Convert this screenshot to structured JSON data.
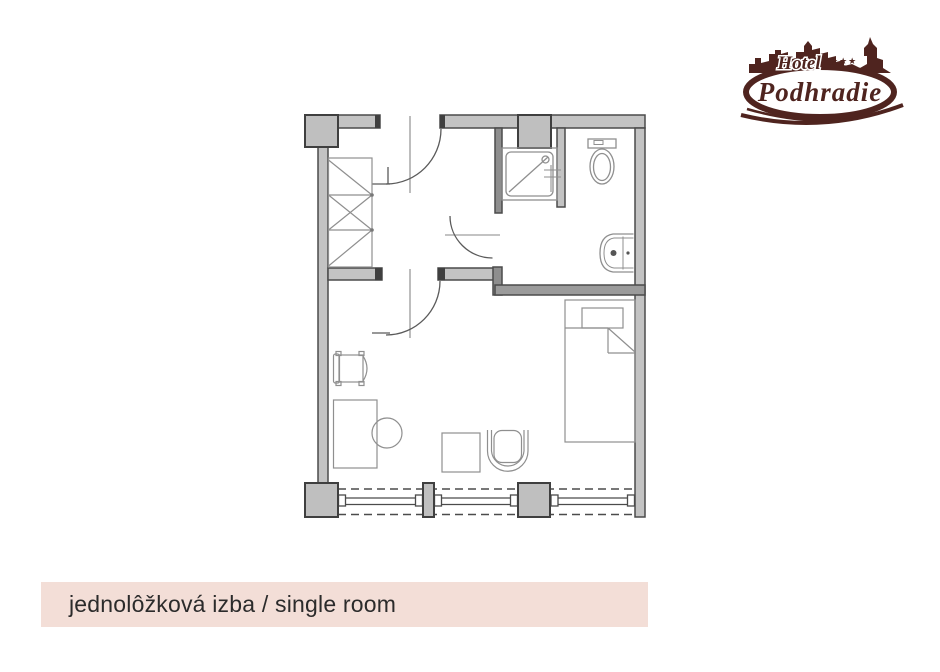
{
  "page": {
    "background": "#ffffff"
  },
  "logo": {
    "hotel_label": "Hotel",
    "stars": "★★★",
    "name": "Podhradie",
    "color": "#4f241f"
  },
  "caption": {
    "text": "jednolôžková izba / single room",
    "background": "#f3ded7",
    "text_color": "#2b2b2b"
  },
  "floor_plan": {
    "wall_fill": "#c3c3c3",
    "wall_stroke": "#4b4b4b",
    "furniture_stroke": "#8f8f8f",
    "window_style": "dashed-opening-with-double-glazing-lines",
    "rooms": [
      "vestibule",
      "bathroom",
      "bedroom"
    ],
    "elements": [
      "entrance-door",
      "room-door",
      "bathroom-door",
      "wardrobe",
      "shower",
      "toilet",
      "sink",
      "armchair",
      "desk",
      "stool",
      "side-table",
      "tub-chair",
      "single-bed",
      "window-wall",
      "columns"
    ]
  }
}
